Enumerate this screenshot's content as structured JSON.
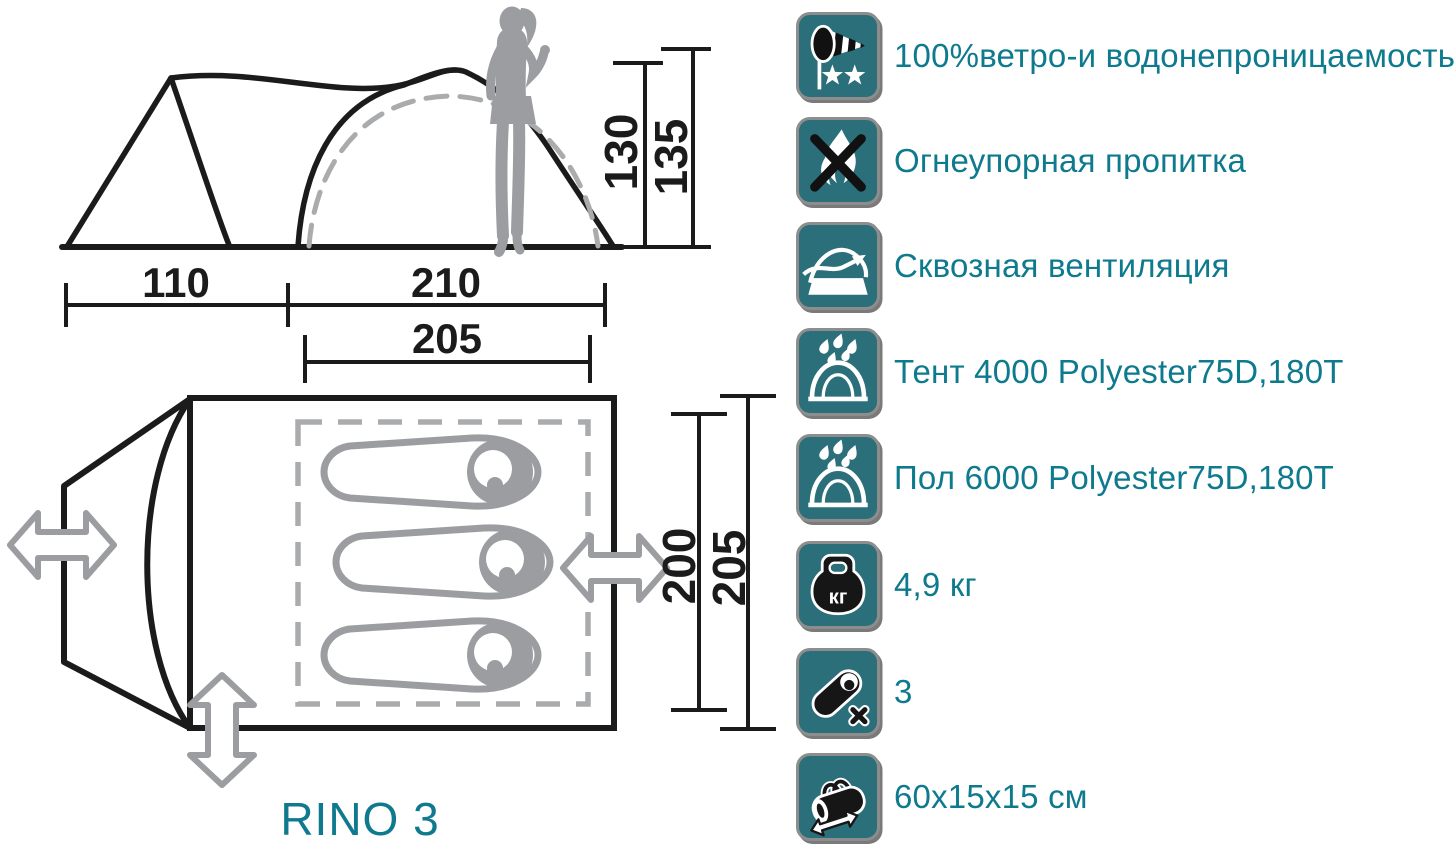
{
  "title": "RINO 3",
  "side_view": {
    "dim_width_left": "110",
    "dim_width_right": "210",
    "dim_width_inner": "205",
    "dim_height_inner": "130",
    "dim_height_outer": "135"
  },
  "floor_plan": {
    "dim_depth_inner": "200",
    "dim_depth_outer": "205",
    "sleeping_places": 3
  },
  "features": [
    {
      "icon": "windsock-icon",
      "label": "100%ветро-и водонепроницаемость"
    },
    {
      "icon": "no-fire-icon",
      "label": "Огнеупорная пропитка"
    },
    {
      "icon": "ventilation-icon",
      "label": "Сквозная вентиляция"
    },
    {
      "icon": "rain-tent-icon",
      "label": "Тент  4000  Polyester75D,180T"
    },
    {
      "icon": "rain-floor-icon",
      "label": "Пол  6000  Polyester75D,180T"
    },
    {
      "icon": "weight-icon",
      "label": "4,9 кг",
      "icon_text": "кг"
    },
    {
      "icon": "sleeping-bag-icon",
      "label": "3"
    },
    {
      "icon": "carry-bag-icon",
      "label": "60x15x15 см"
    }
  ],
  "colors": {
    "icon_teal": "#2a6f7a",
    "text_teal": "#0d7a8e",
    "diagram_grey": "#9b9da0",
    "line_black": "#1b1b1b"
  }
}
